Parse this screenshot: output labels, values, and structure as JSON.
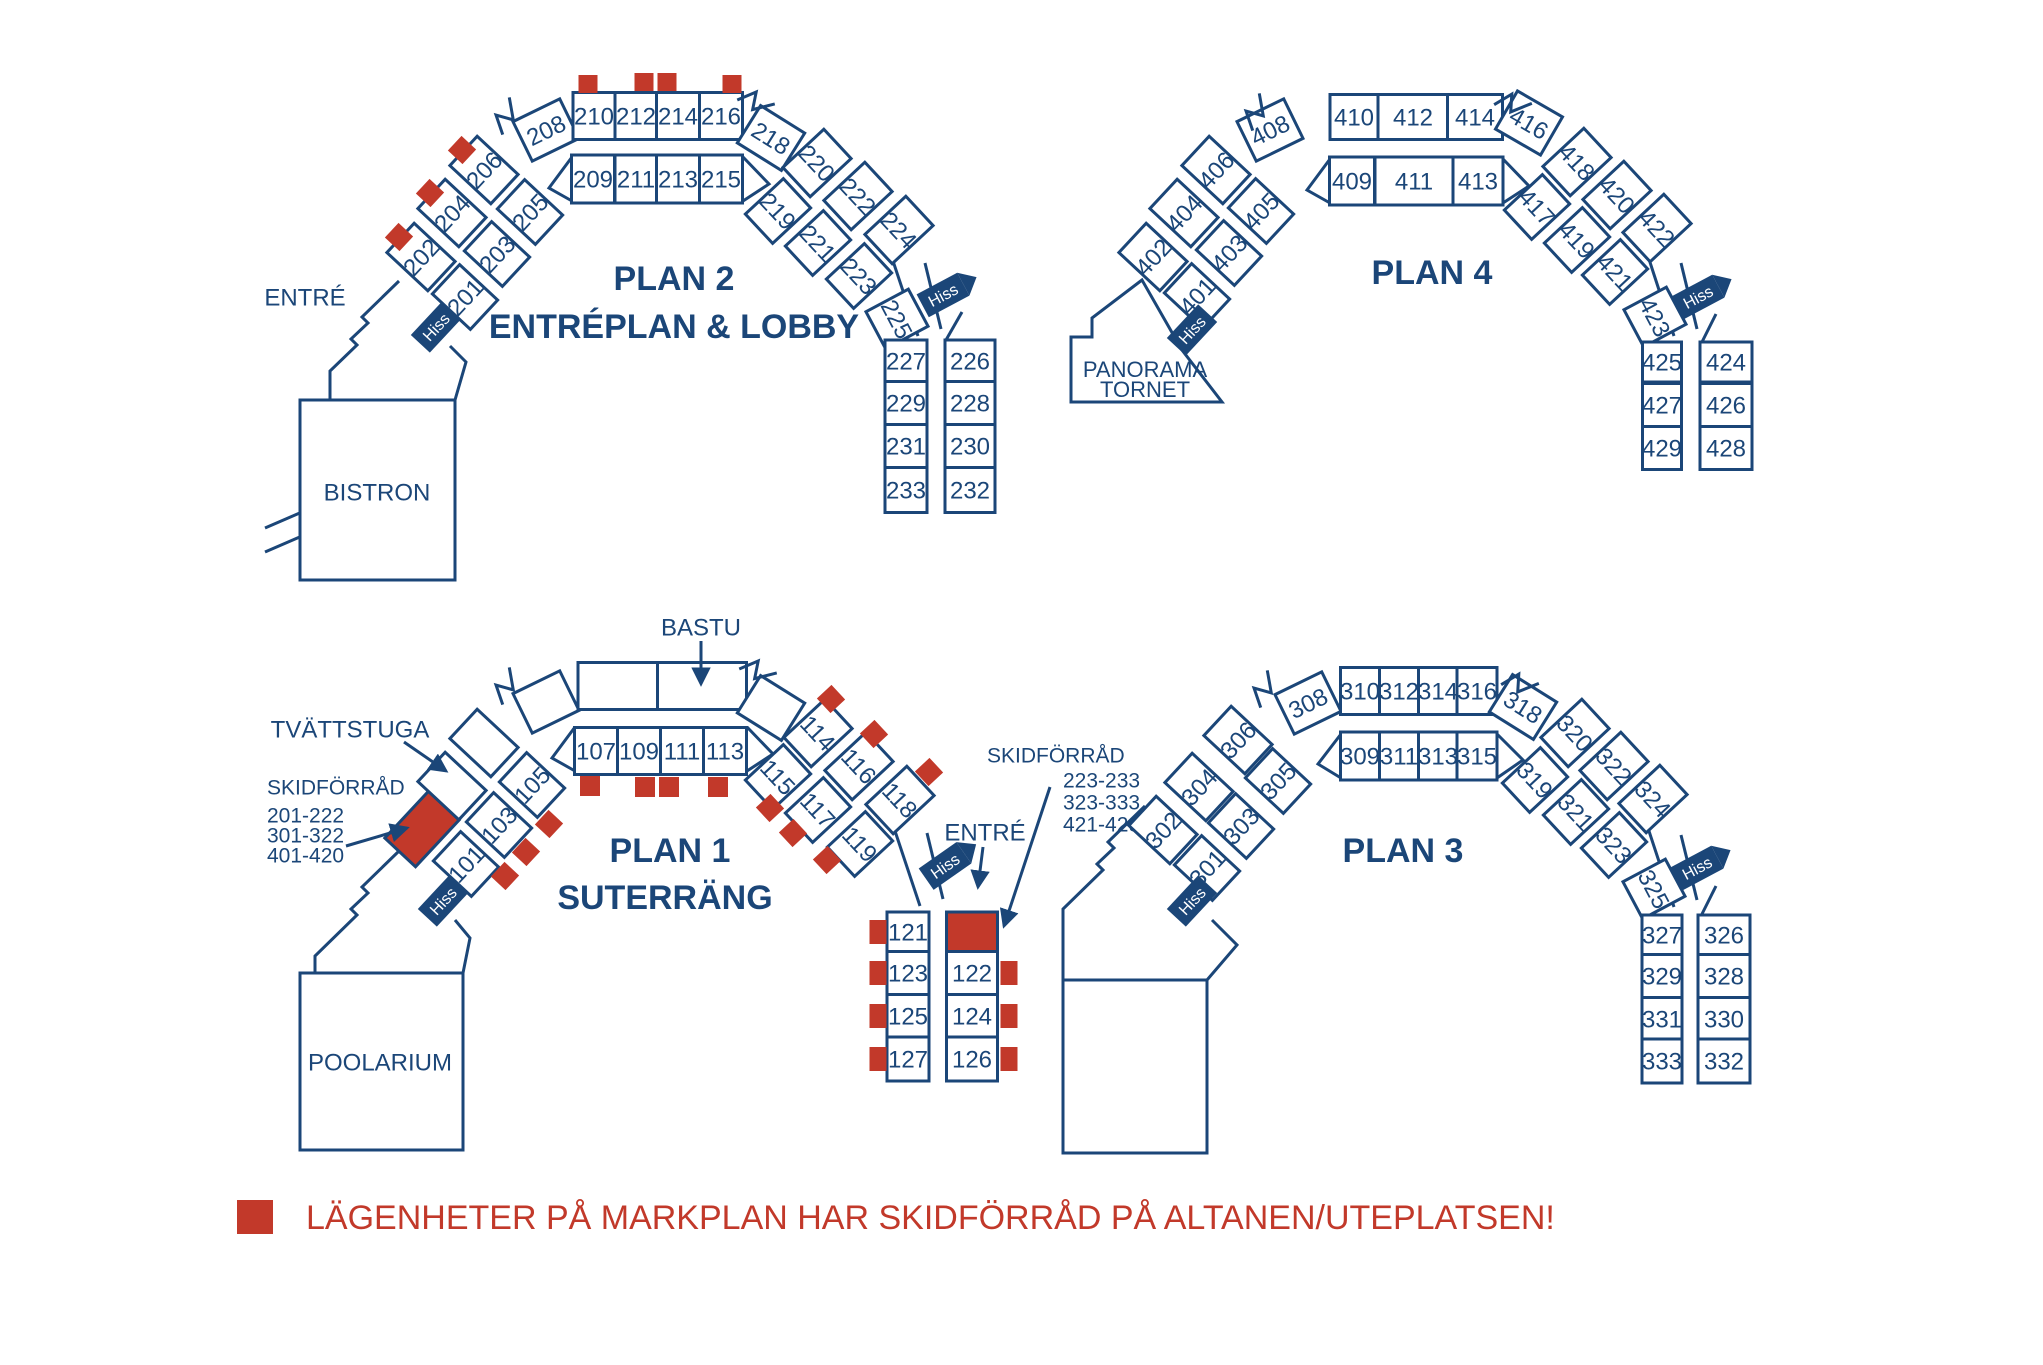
{
  "colors": {
    "navy": "#1b4678",
    "red": "#c2392a",
    "white": "#ffffff"
  },
  "legend": {
    "text": "LÄGENHETER PÅ MARKPLAN HAR SKIDFÖRRÅD PÅ ALTANEN/UTEPLATSEN!"
  },
  "labels": {
    "hiss": "Hiss",
    "entre": "ENTRÉ",
    "bastu": "BASTU",
    "tvattstuga": "TVÄTTSTUGA",
    "bistron": "BISTRON",
    "poolarium": "POOLARIUM",
    "panorama": [
      "PANORAMA",
      "TORNET"
    ],
    "skidforrad_left": [
      "SKIDFÖRRÅD",
      "201-222",
      "301-322",
      "401-420"
    ],
    "skidforrad_right": [
      "SKIDFÖRRÅD",
      "223-233",
      "323-333",
      "421-429"
    ]
  },
  "plans": {
    "plan1": {
      "title": "PLAN 1",
      "subtitle": "SUTERRÄNG",
      "inner_sw": [
        "101",
        "103",
        "105"
      ],
      "top_inner": [
        "107",
        "109",
        "111",
        "113"
      ],
      "se_outer": [
        "114",
        "116",
        "118"
      ],
      "se_inner": [
        "115",
        "117",
        "119"
      ],
      "col_left": [
        "121",
        "123",
        "125",
        "127"
      ],
      "col_right": [
        "122",
        "124",
        "126"
      ]
    },
    "plan2": {
      "title": "PLAN 2",
      "subtitle": "ENTRÉPLAN & LOBBY",
      "outer": [
        "202",
        "204",
        "206",
        "208",
        "210",
        "212",
        "214",
        "216",
        "218",
        "220",
        "222",
        "224"
      ],
      "inner": [
        "201",
        "203",
        "205",
        "209",
        "211",
        "213",
        "215",
        "219",
        "221",
        "223",
        "225"
      ],
      "col_left": [
        "227",
        "229",
        "231",
        "233"
      ],
      "col_right": [
        "226",
        "228",
        "230",
        "232"
      ]
    },
    "plan3": {
      "title": "PLAN 3",
      "outer": [
        "302",
        "304",
        "306",
        "308",
        "310",
        "312",
        "314",
        "316",
        "318",
        "320",
        "322",
        "324"
      ],
      "inner": [
        "301",
        "303",
        "305",
        "309",
        "311",
        "313",
        "315",
        "319",
        "321",
        "323",
        "325"
      ],
      "col_left": [
        "327",
        "329",
        "331",
        "333"
      ],
      "col_right": [
        "326",
        "328",
        "330",
        "332"
      ]
    },
    "plan4": {
      "title": "PLAN 4",
      "outer": [
        "402",
        "404",
        "406",
        "408",
        "410",
        "412",
        "414",
        "416",
        "418",
        "420",
        "422"
      ],
      "inner": [
        "401",
        "403",
        "405",
        "409",
        "411",
        "413",
        "417",
        "419",
        "421",
        "423"
      ],
      "col_left": [
        "425",
        "427",
        "429"
      ],
      "col_right": [
        "424",
        "426",
        "428"
      ]
    }
  }
}
